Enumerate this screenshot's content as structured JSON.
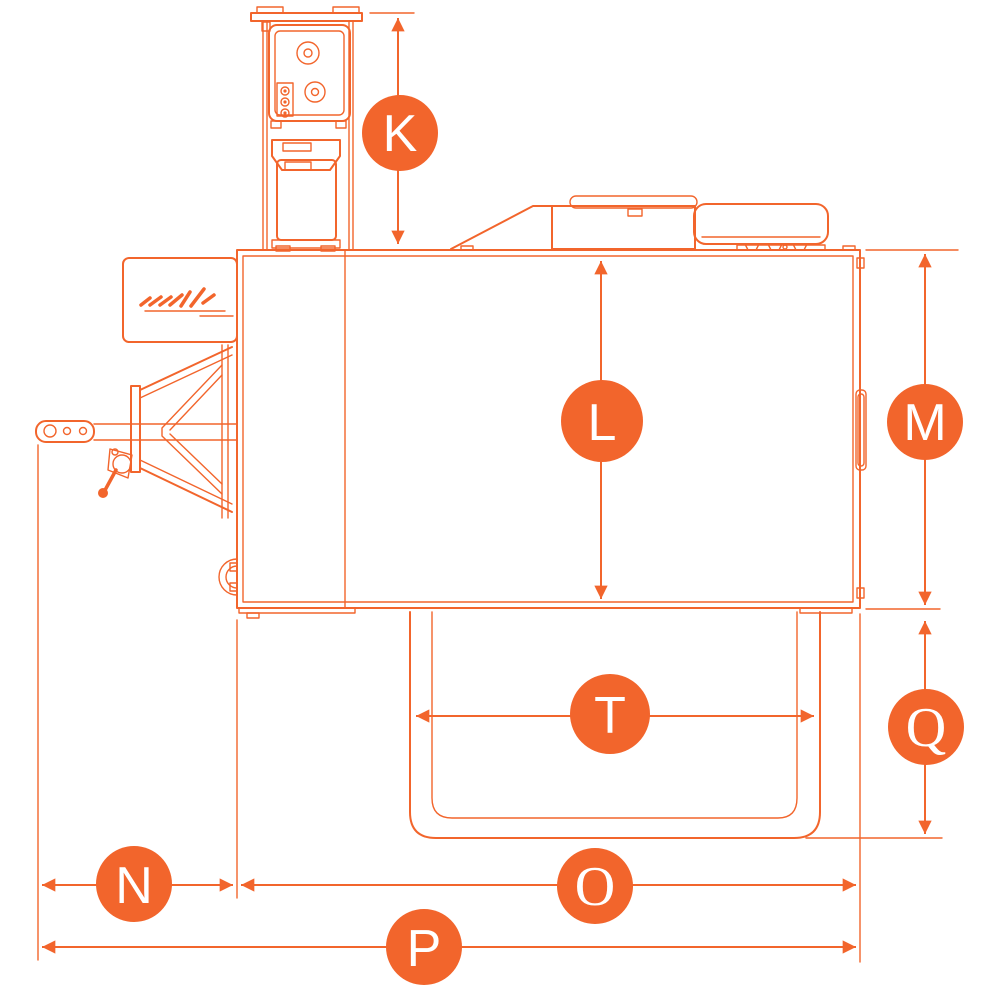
{
  "colors": {
    "accent": "#f2652c",
    "letter": "#ffffff",
    "background": "#ffffff"
  },
  "dimensions": {
    "K": {
      "label": "K",
      "orientation": "vertical",
      "measures": "stack-height-above-roof"
    },
    "L": {
      "label": "L",
      "orientation": "vertical",
      "measures": "body-height"
    },
    "M": {
      "label": "M",
      "orientation": "vertical",
      "measures": "body-height-rear"
    },
    "Q": {
      "label": "Q",
      "orientation": "vertical",
      "measures": "lower-box-height"
    },
    "T": {
      "label": "T",
      "orientation": "horizontal",
      "measures": "lower-box-width"
    },
    "N": {
      "label": "N",
      "orientation": "horizontal",
      "measures": "drawbar-length"
    },
    "O": {
      "label": "O",
      "orientation": "horizontal",
      "measures": "body-length"
    },
    "P": {
      "label": "P",
      "orientation": "horizontal",
      "measures": "overall-length"
    }
  }
}
